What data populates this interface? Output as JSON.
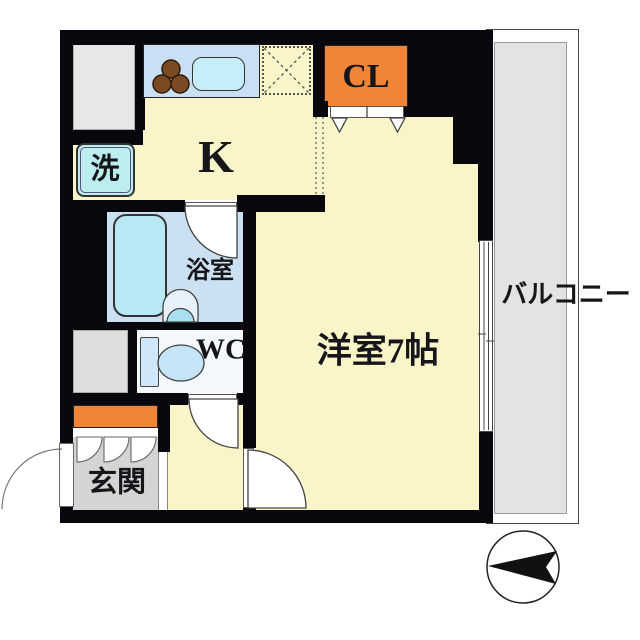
{
  "title": "apartment-floor-plan",
  "rooms": {
    "kitchen": {
      "label": "K"
    },
    "closet": {
      "label": "CL"
    },
    "washer": {
      "label": "洗"
    },
    "bathroom": {
      "label": "浴室"
    },
    "toilet": {
      "label": "WC"
    },
    "entrance": {
      "label": "玄関"
    },
    "main_room": {
      "label": "洋室7帖"
    },
    "balcony": {
      "label": "バルコニー"
    }
  },
  "colors": {
    "wall": "#07070d",
    "floor_yellow": "#FAF5C9",
    "accent_orange": "#F08437",
    "counter_blue": "#C9DFF4",
    "bath_floor": "#CBE1F2",
    "tub_cyan": "#B8E9F5",
    "washer_cyan": "#BCEDEF",
    "entrance_gray": "#D4D4D4",
    "balcony_gray": "#E3E3E3",
    "service_gray": "#E7E7E7",
    "wc_floor": "#F3F8FC"
  },
  "icons": {
    "compass": "north-arrow-pointing-left",
    "stove": "3-burner-stove",
    "fridge_space": "dashed-box-with-x"
  }
}
